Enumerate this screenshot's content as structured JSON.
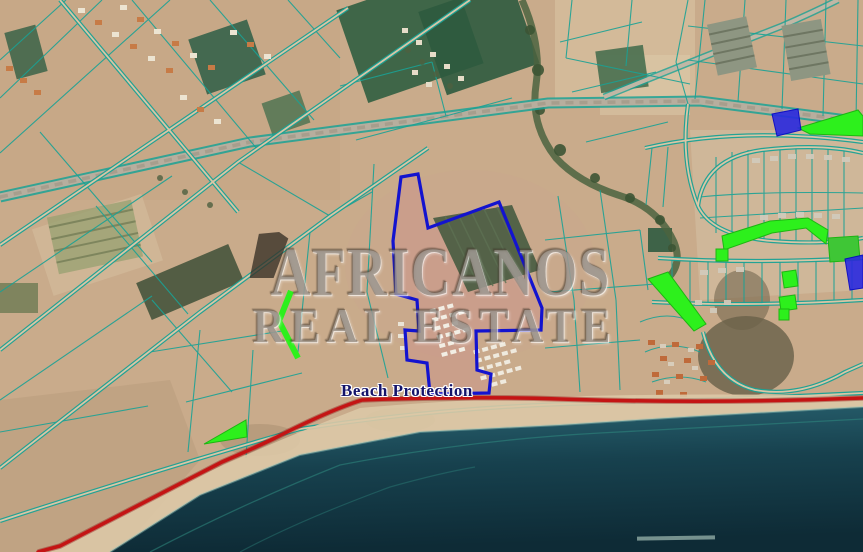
{
  "map": {
    "watermark": {
      "line1": "AFRICANOS",
      "line2": "REAL ESTATE"
    },
    "labels": {
      "beach_protection": "Beach Protection"
    },
    "colors": {
      "parcel_line_teal": "#1aa295",
      "highlight_blue": "#1414d0",
      "highlight_green": "#2df01c",
      "beach_protection_red": "#c41414",
      "sea_dark": "#12333f",
      "land_tan": "#c9ab8b"
    }
  }
}
